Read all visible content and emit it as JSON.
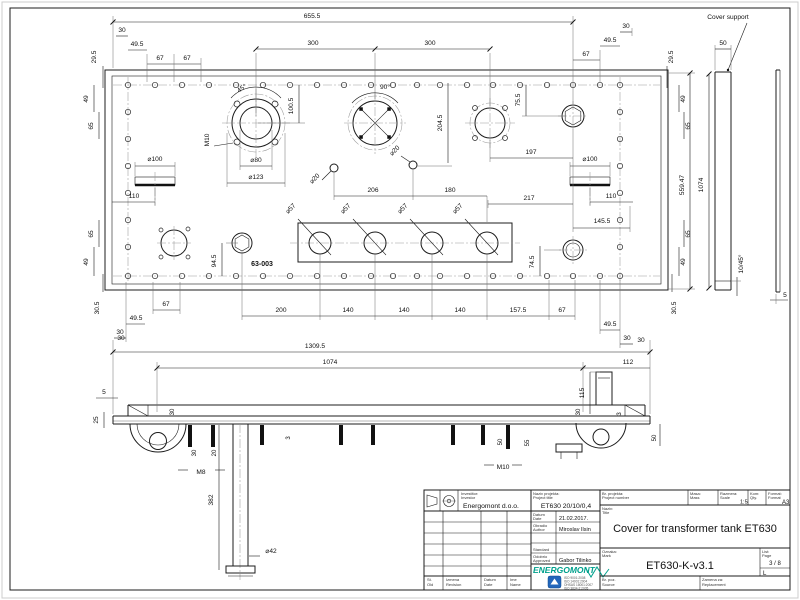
{
  "labels": {
    "cover_support": "Cover support",
    "part_ref": "63-003"
  },
  "dims": {
    "v655_5": "655.5",
    "v300": "300",
    "v30": "30",
    "v49_5": "49.5",
    "v67": "67",
    "v29_5": "29.5",
    "v49": "49",
    "v65": "65",
    "v30_5": "30.5",
    "a45": "45°",
    "a90": "90°",
    "v100_5": "100.5",
    "v204_5": "204.5",
    "v75_5": "75.5",
    "v197": "197",
    "v206": "206",
    "v180": "180",
    "v217": "217",
    "v145_5": "145.5",
    "v110": "110",
    "v94_5": "94.5",
    "v74_5": "74.5",
    "v200": "200",
    "v140": "140",
    "v157_5": "157.5",
    "v559_47": "559.47",
    "v1074": "1074",
    "v50": "50",
    "v5": "5",
    "v1309_5": "1309.5",
    "v112": "112",
    "v115": "115",
    "v25": "25",
    "v20": "20",
    "v3": "3",
    "v55": "55",
    "v382": "382",
    "d80": "⌀80",
    "d123": "⌀123",
    "d100": "⌀100",
    "d20": "⌀20",
    "d57": "⌀57",
    "d42": "⌀42",
    "m8": "M8",
    "m10": "M10",
    "chamfer": "10/45°"
  },
  "tb": {
    "investor_sr": "Investitor:",
    "investor_en": "Investor",
    "investor": "Energomont d.o.o.",
    "project_sr": "Naziv projekta:",
    "project_en": "Project title",
    "project": "ET630 20/10/0,4",
    "date_sr": "Datum",
    "date_en": "Date",
    "date": "21.02.2017.",
    "author_sr": "Obradio",
    "author_en": "Author",
    "author": "Miroslav Ilsin",
    "standard": "Standard",
    "approved_sr": "Odobrio",
    "approved_en": "Approved",
    "approved": "Gabor Tilinko",
    "logo": "ENERGOMONT",
    "certs": [
      "ISO 9001:2008",
      "ISO 14001:2004",
      "OHSAS 18001:2007",
      "ISO 3834-2:2005"
    ],
    "pnum_sr": "Br. projekta:",
    "pnum_en": "Project number",
    "mass_sr": "Masa:",
    "mass_en": "Mass",
    "scale_sr": "Razmera:",
    "scale_en": "Scale",
    "scale": "1:5",
    "qty_sr": "Kom:",
    "qty_en": "Qty.",
    "format_sr": "Format:",
    "format_en": "Format",
    "format": "A3",
    "title_sr": "Naziv:",
    "title_en": "Title",
    "title": "Cover for transformer tank ET630",
    "mark_sr": "Oznaka:",
    "mark_en": "Mark",
    "mark": "ET630-K-v3.1",
    "page_sr": "List:",
    "page_en": "Page",
    "page": "3 / 8",
    "size": "L",
    "rev_sr": "St.",
    "rev_en": "Old",
    "change_sr": "Izmena",
    "change_en": "Revision",
    "date2_sr": "Datum",
    "date2_en": "Date",
    "name_sr": "Ime",
    "name_en": "Name",
    "src_sr": "Br. poz.",
    "src_en": "Source",
    "repl_sr": "Zamena za:",
    "repl_en": "Replacement"
  }
}
